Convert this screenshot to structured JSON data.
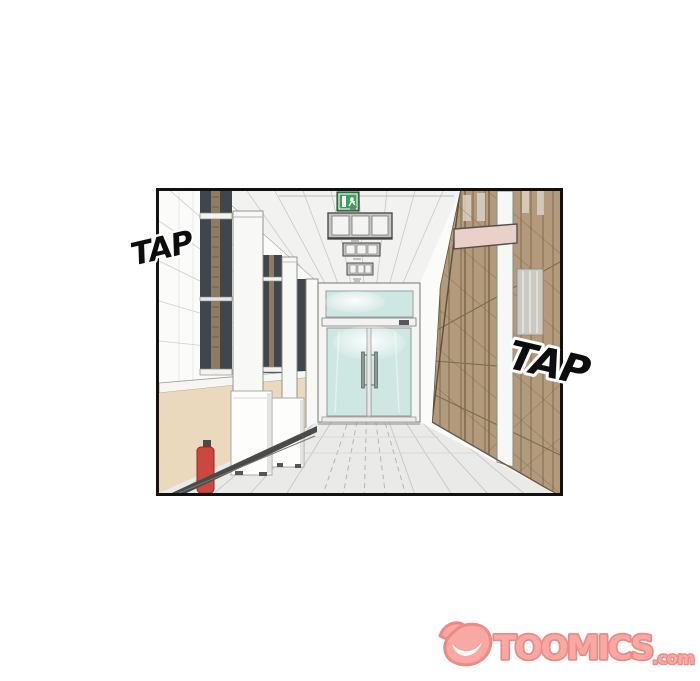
{
  "page": {
    "background_color": "#ffffff"
  },
  "panel": {
    "border_color": "#111111"
  },
  "sfx": {
    "left": "TAP",
    "right": "TAP",
    "text_color": "#0d0d0d",
    "outline_color": "#ffffff"
  },
  "watermark": {
    "brand": "TOOMICS",
    "tld": ".com",
    "fill_color": "#f9a8a4",
    "outline_color": "#ec8a86"
  },
  "scene": {
    "colors": {
      "wall_white": "#fbfbfa",
      "ceiling": "#f2f2f0",
      "ceiling_line": "#c9c9c6",
      "wainscot_beige": "#ead9bd",
      "sill_white": "#f7f6f3",
      "window_dark": "#41464d",
      "window_blind_tan": "#8d7c62",
      "wood_wall": "#b39a7c",
      "wood_line": "#7f6b51",
      "glass_teal": "#cfe7e3",
      "floor_gray": "#eaeae8",
      "floor_line": "#c6c6c3",
      "exit_sign_green": "#3f9f5f",
      "name_plate_pink": "#e9d0c9",
      "extinguisher_red": "#cd4640",
      "cabinet_white": "#fdfdfc",
      "baseboard_dark": "#4a4a48"
    }
  }
}
